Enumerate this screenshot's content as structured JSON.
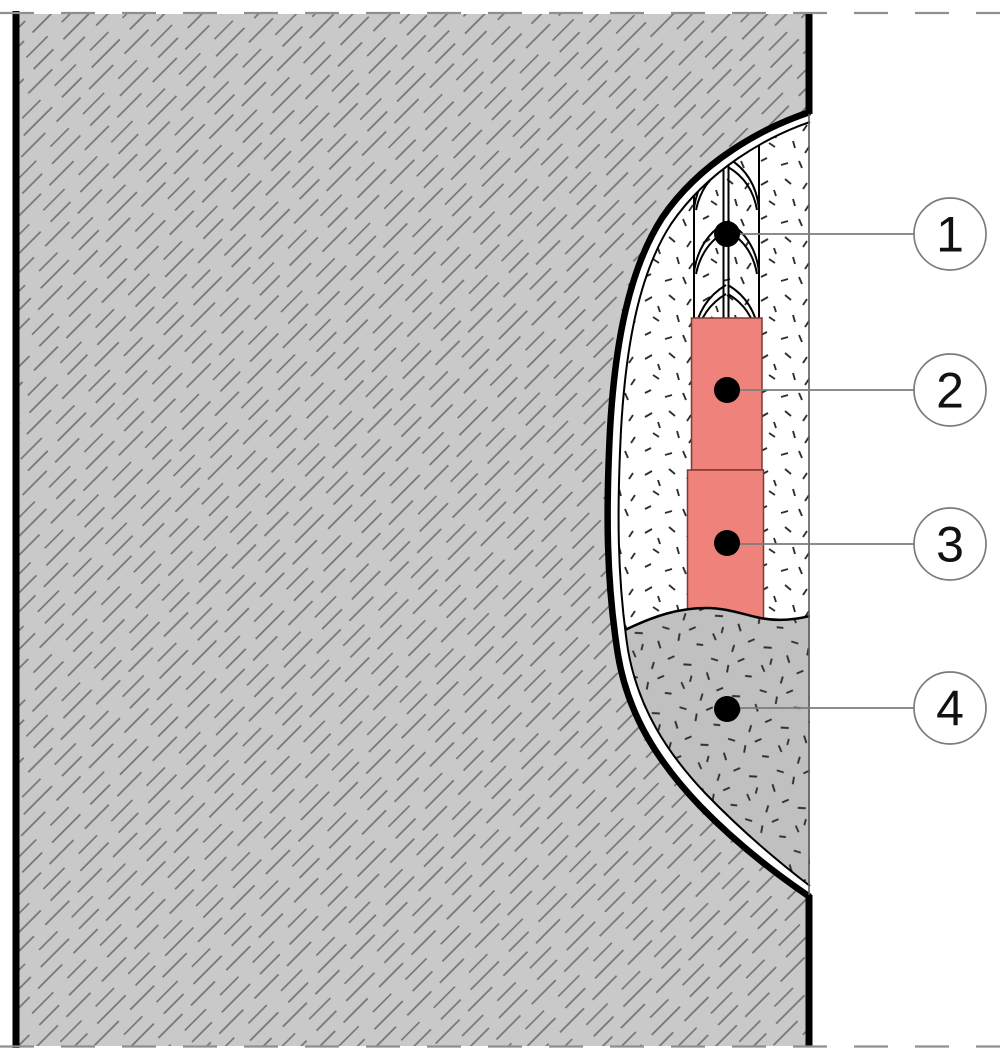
{
  "drawing": {
    "kind": "wall-section-repair-detail",
    "callouts": [
      {
        "label": "1"
      },
      {
        "label": "2"
      },
      {
        "label": "3"
      },
      {
        "label": "4"
      }
    ],
    "colors": {
      "wall_fill": "#c9c9c9",
      "hatch_line": "#757575",
      "pocket_infill_gray": "#c0c0c0",
      "filler_red": "#ef827b",
      "filler_red_stroke": "#7c3a33",
      "stipple_tick": "#2f2f2f",
      "line_black": "#000000",
      "leader_gray": "#7b7b7b",
      "cut_dash_gray": "#8f8f8f"
    }
  }
}
